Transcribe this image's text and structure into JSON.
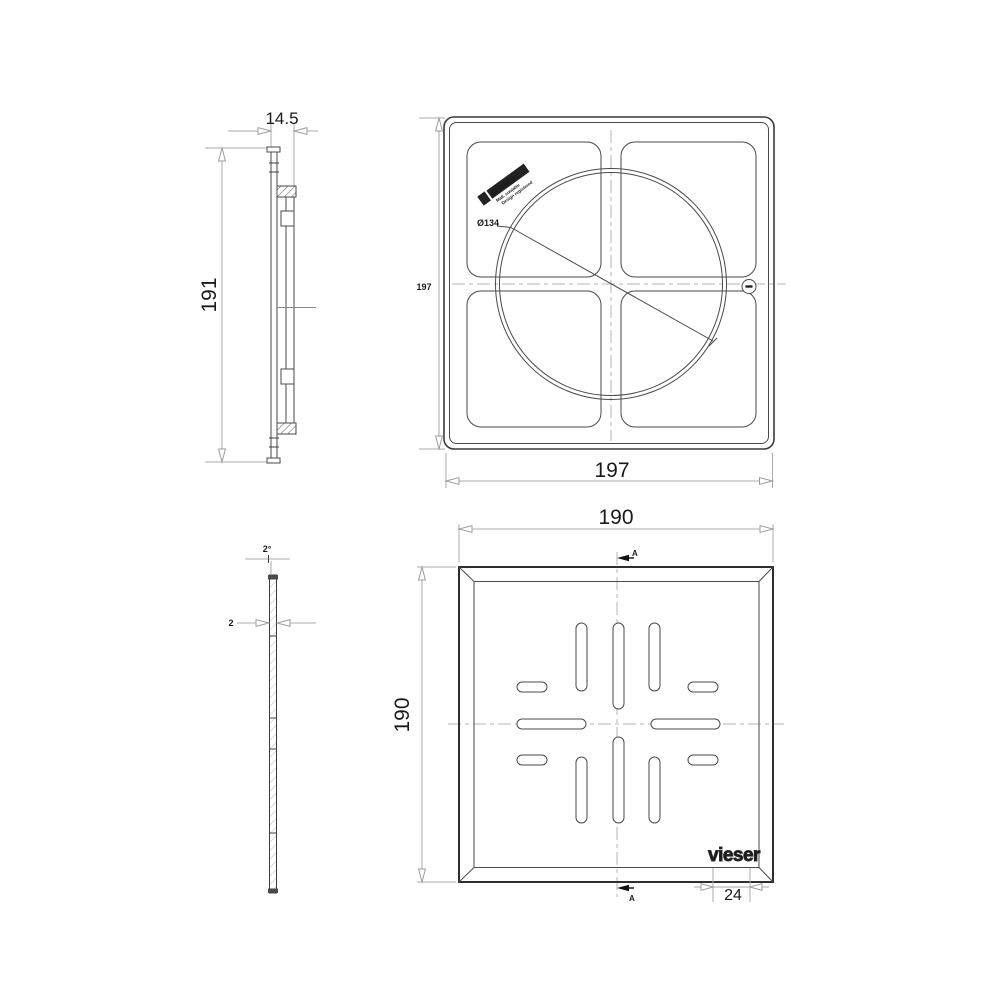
{
  "views": {
    "frame_side": {
      "width": "14.5",
      "height": "191"
    },
    "frame_front": {
      "width": "197",
      "height": "197",
      "diameter": "Ø134",
      "brand_logo": {
        "main": "SERRES®",
        "sub1": "Mall. suojattu",
        "sub2": "Design registered"
      }
    },
    "grate_side": {
      "thickness": "2",
      "draft_angle": "2°"
    },
    "grate_front": {
      "width": "190",
      "height": "190",
      "section_label_top": "A",
      "section_label_bottom": "A",
      "brand_logo": "vieser",
      "logo_width": "24"
    }
  }
}
